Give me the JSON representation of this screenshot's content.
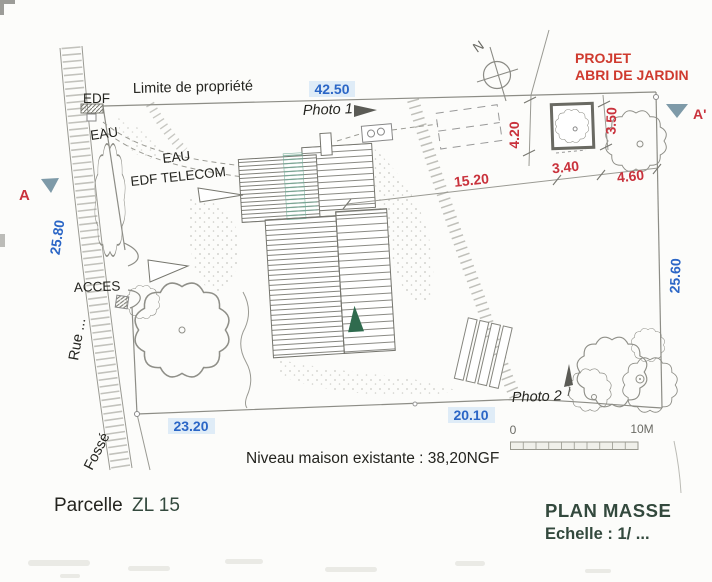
{
  "colors": {
    "dim_red": "#c9323c",
    "project_red": "#cf3a2e",
    "dim_blue": "#2b66c6",
    "highlight": "#d7e7f6",
    "section_arrow": "#7e9aa8",
    "tree_green": "#2f6b4e",
    "roof_teal": "#74ab97",
    "heading": "#33493d",
    "ink": "#24241f",
    "muted": "#6b6b65"
  },
  "annotations": {
    "property_limit": "Limite de propriété",
    "photo1": "Photo 1",
    "photo2": "Photo 2",
    "access": "ACCES",
    "street": "Rue ...",
    "ditch": "Fossé",
    "project_line1": "PROJET",
    "project_line2": "ABRI DE JARDIN",
    "north": "N",
    "section_start": "A",
    "section_end": "A'"
  },
  "utilities": {
    "edf": "EDF",
    "eau_top": "EAU",
    "eau_mid": "EAU",
    "edf_telecom": "EDF TELECOM"
  },
  "dimensions_m": {
    "front": "42.50",
    "left": "25.80",
    "right": "25.60",
    "rear_left": "23.20",
    "rear_right": "20.10",
    "shed_offset": "4.20",
    "shed_depth": "3.50",
    "house_to_shed": "15.20",
    "shed_width": "3.40",
    "shed_to_corner": "4.60"
  },
  "scale_bar": {
    "start": "0",
    "end": "10M"
  },
  "title_block": {
    "parcel_label": "Parcelle",
    "parcel_value": "ZL 15",
    "plan_title": "PLAN MASSE",
    "scale_label": "Echelle : 1/ ...",
    "level_note": "Niveau maison existante : 38,20NGF"
  }
}
